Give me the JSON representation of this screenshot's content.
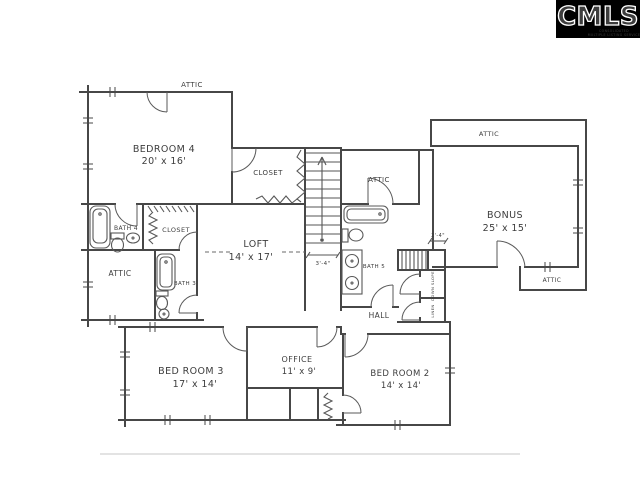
{
  "logo": {
    "brand": "CMLS",
    "tagline_line1": "CONSOLIDATED",
    "tagline_line2": "MULTIPLE LISTING SERVICE"
  },
  "rooms": [
    {
      "name": "BEDROOM 4",
      "dims": "20' x 16'"
    },
    {
      "name": "CLOSET"
    },
    {
      "name": "BONUS",
      "dims": "25' x 15'"
    },
    {
      "name": "LOFT",
      "dims": "14' x 17'"
    },
    {
      "name": "BATH 4"
    },
    {
      "name": "CLOSET"
    },
    {
      "name": "ATTIC"
    },
    {
      "name": "BATH 3"
    },
    {
      "name": "BATH 5"
    },
    {
      "name": "HALL"
    },
    {
      "name": "BED ROOM 3",
      "dims": "17' x 14'"
    },
    {
      "name": "OFFICE",
      "dims": "11' x 9'"
    },
    {
      "name": "BED ROOM 2",
      "dims": "14' x 14'"
    }
  ],
  "annotations": {
    "attic_top": "ATTIC",
    "attic_mid": "ATTIC",
    "attic_bonus_top": "ATTIC",
    "attic_bonus_bottom": "ATTIC",
    "dim_stairs": "3'-4\"",
    "dim_back_stairs": "2'-4\"",
    "closet_upper": "DOWN SLOPE",
    "closet_lower": "LINEN"
  },
  "colors": {
    "ink": "#474747",
    "paper": "#ffffff",
    "logo_bg": "#000000",
    "logo_fg": "#ffffff"
  }
}
